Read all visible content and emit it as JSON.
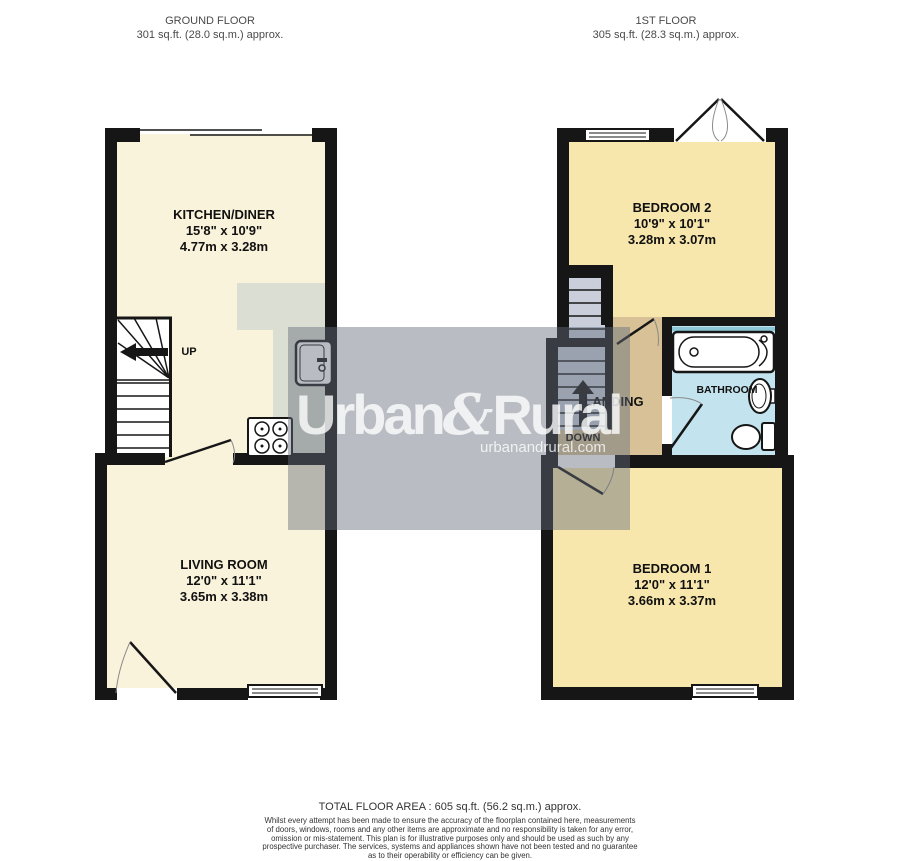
{
  "ground_floor": {
    "title": "GROUND FLOOR",
    "area": "301 sq.ft. (28.0 sq.m.) approx.",
    "kitchen": {
      "name": "KITCHEN/DINER",
      "size_imperial": "15'8\" x 10'9\"",
      "size_metric": "4.77m x 3.28m"
    },
    "living": {
      "name": "LIVING ROOM",
      "size_imperial": "12'0\" x 11'1\"",
      "size_metric": "3.65m x 3.38m"
    },
    "stairs": {
      "up": "UP"
    }
  },
  "first_floor": {
    "title": "1ST FLOOR",
    "area": "305 sq.ft. (28.3 sq.m.) approx.",
    "bedroom2": {
      "name": "BEDROOM 2",
      "size_imperial": "10'9\" x 10'1\"",
      "size_metric": "3.28m x 3.07m"
    },
    "bedroom1": {
      "name": "BEDROOM 1",
      "size_imperial": "12'0\" x 11'1\"",
      "size_metric": "3.66m x 3.37m"
    },
    "bathroom": {
      "name": "BATHROOM"
    },
    "landing": {
      "name": "LANDING",
      "down": "DOWN"
    }
  },
  "watermark": {
    "brand_a": "Urban",
    "brand_amp": "&",
    "brand_b": "Rural",
    "website": "urbanandrural.com"
  },
  "footer": {
    "total_area": "TOTAL FLOOR AREA : 605 sq.ft. (56.2 sq.m.) approx.",
    "disclaimer_lines": [
      "Whilst every attempt has been made to ensure the accuracy of the floorplan contained here, measurements",
      "of doors, windows, rooms and any other items are approximate and no responsibility is taken for any error,",
      "omission or mis-statement. This plan is for illustrative purposes only and should be used as such by any",
      "prospective purchaser. The services, systems and appliances shown have not been tested and no guarantee",
      "as to their operability or efficiency can be given.",
      "Made with Metropix ©2025"
    ]
  },
  "colors": {
    "wall": "#161616",
    "cream": "#FAF3DB",
    "bedroom": "#F8E7AC",
    "bathroom_floor": "#C3E4EE",
    "landing_floor": "#D8C197",
    "counter": "#DBDED2",
    "stair_gf": "#FFFFFF",
    "stair_1f": "#C9CEDA",
    "bath_screen": "#8CC8D8",
    "watermark_band": "rgba(100,108,122,0.45)",
    "watermark_text": "rgba(255,255,255,0.78)",
    "header_text": "#4A4A4A",
    "label_text": "#111111",
    "footer_text": "#333333",
    "window_glass": "#FFFFFF"
  }
}
